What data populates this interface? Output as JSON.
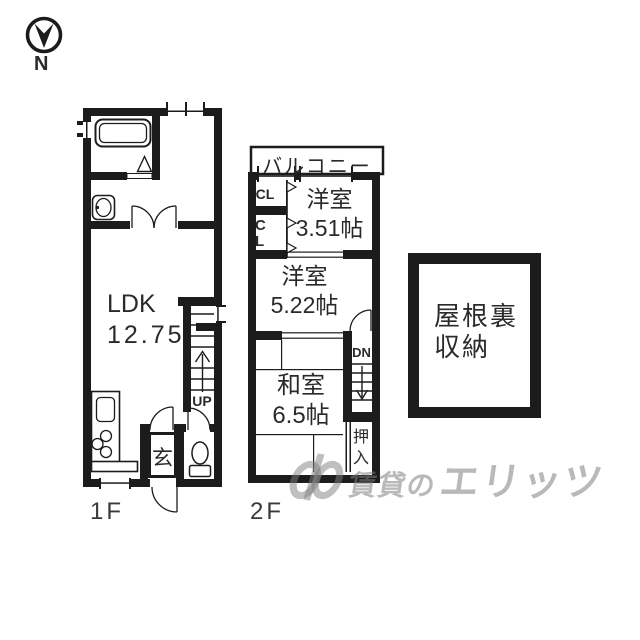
{
  "compass": {
    "label": "N"
  },
  "floor1": {
    "label": "1F",
    "ldk_name": "LDK",
    "ldk_size": "12.75",
    "genkan": "玄",
    "up": "UP"
  },
  "floor2": {
    "label": "2F",
    "balcony": "バルコニー",
    "closet_upper": "CL",
    "closet_lower": "CL",
    "room_small_name": "洋室",
    "room_small_size": "3.51帖",
    "room_mid_name": "洋室",
    "room_mid_size": "5.22帖",
    "japanese_room_name": "和室",
    "japanese_room_size": "6.5帖",
    "oshiire": "押入",
    "down": "DN"
  },
  "attic": {
    "line1": "屋根裏",
    "line2": "収納"
  },
  "watermark": {
    "prefix": "賃貸の",
    "brand": "エリッツ"
  },
  "colors": {
    "wall": "#1c1c1c",
    "text": "#2a2a2a",
    "floor_label": "#3a3a3a",
    "watermark": "rgba(128,128,128,0.55)"
  }
}
